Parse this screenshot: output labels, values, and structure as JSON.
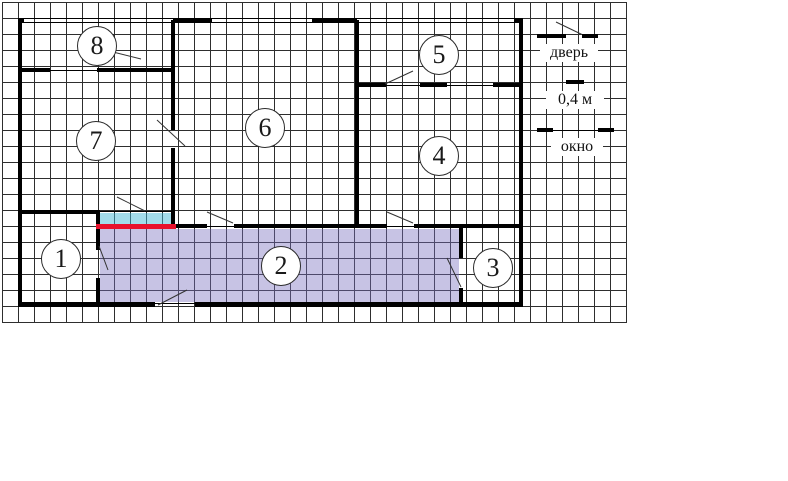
{
  "legend": {
    "door_label": "дверь",
    "scale_label": "0,4 м",
    "window_label": "окно"
  },
  "rooms": [
    {
      "number": "1"
    },
    {
      "number": "2"
    },
    {
      "number": "3"
    },
    {
      "number": "4"
    },
    {
      "number": "5"
    },
    {
      "number": "6"
    },
    {
      "number": "7"
    },
    {
      "number": "8"
    }
  ],
  "colors": {
    "wall": "#000000",
    "grid_line": "#2e2e2e",
    "red_wall": "#e8112d",
    "cyan_strip": "rgba(70,185,215,0.5)",
    "room2_fill": "rgba(122,112,190,0.42)"
  }
}
